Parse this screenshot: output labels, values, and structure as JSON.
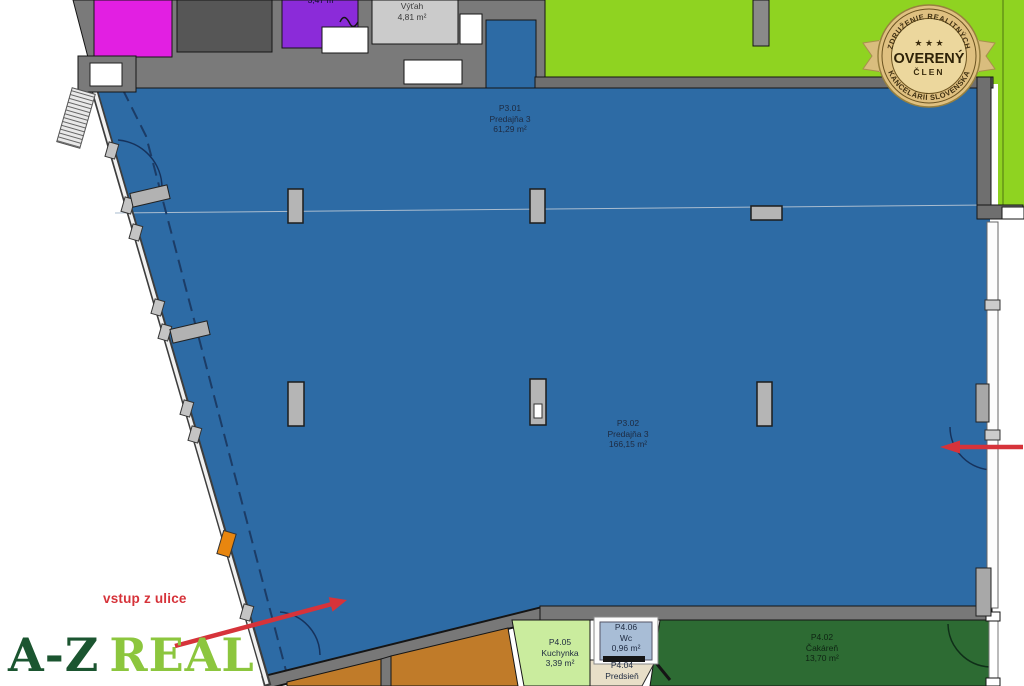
{
  "plan": {
    "rooms": {
      "p301": {
        "id": "P3.01",
        "name": "Predajňa 3",
        "area": "61,29 m²"
      },
      "p302": {
        "id": "P3.02",
        "name": "Predajňa 3",
        "area": "166,15 m²"
      },
      "vytah": {
        "name": "Výťah",
        "area": "4,81 m²"
      },
      "top_partial": {
        "area": "3,47 m²"
      },
      "p405": {
        "id": "P4.05",
        "name": "Kuchynka",
        "area": "3,39 m²"
      },
      "p406": {
        "id": "P4.06",
        "name": "Wc",
        "area": "0,96 m²"
      },
      "p404": {
        "id": "P4.04",
        "name": "Predsieň"
      },
      "p402": {
        "id": "P4.02",
        "name": "Čakáreň",
        "area": "13,70 m²"
      }
    },
    "annotations": {
      "entrance": "vstup z ulice"
    }
  },
  "badge": {
    "arc_top": "ZDRUŽENIE REALITNÝCH",
    "arc_bottom": "KANCELÁRIÍ SLOVENSKA",
    "stars": "★ ★ ★",
    "title": "OVERENÝ",
    "subtitle": "ČLEN"
  },
  "logo": {
    "first": "A-Z",
    "second": "REAL"
  },
  "colors": {
    "sales_area_blue": "#2d6ba5",
    "yard_green": "#8fd321",
    "waiting_room_green": "#2d6b33",
    "kitchen_green": "#caec9e",
    "storage_orange": "#c07b29",
    "magenta_room": "#e21fe2",
    "purple_room": "#8b2bd9",
    "elevator_gray": "#cbcbcb",
    "wall_gray": "#7a7a7a",
    "arrow_red": "#d6333a",
    "badge_gold": "#dfc080",
    "logo_dark_green": "#1b5530",
    "logo_light_green": "#8cc63e"
  }
}
